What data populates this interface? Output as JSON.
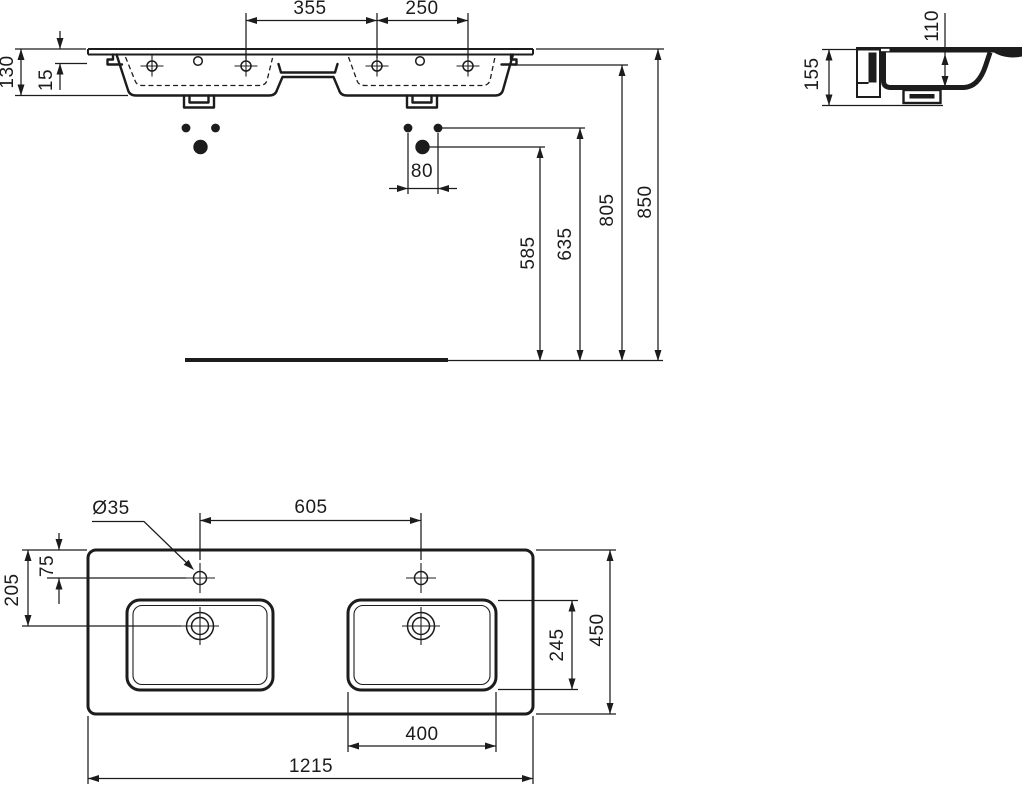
{
  "front_view": {
    "label": "front elevation with installation heights",
    "dims": {
      "hole_spacing_355": "355",
      "hole_spacing_250": "250",
      "total_height_130": "130",
      "deck_thickness_15": "15",
      "fixing_spacing_80": "80",
      "height_585": "585",
      "height_635": "635",
      "height_805": "805",
      "height_850": "850"
    }
  },
  "side_view": {
    "label": "side section",
    "dims": {
      "total_height_155": "155",
      "bowl_depth_110": "110"
    }
  },
  "plan_view": {
    "label": "plan view",
    "dims": {
      "faucet_hole_diameter": "Ø35",
      "faucet_hole_spacing_605": "605",
      "faucet_offset_75": "75",
      "drain_offset_205": "205",
      "bowl_depth_245": "245",
      "total_depth_450": "450",
      "bowl_width_400": "400",
      "total_width_1215": "1215"
    }
  }
}
